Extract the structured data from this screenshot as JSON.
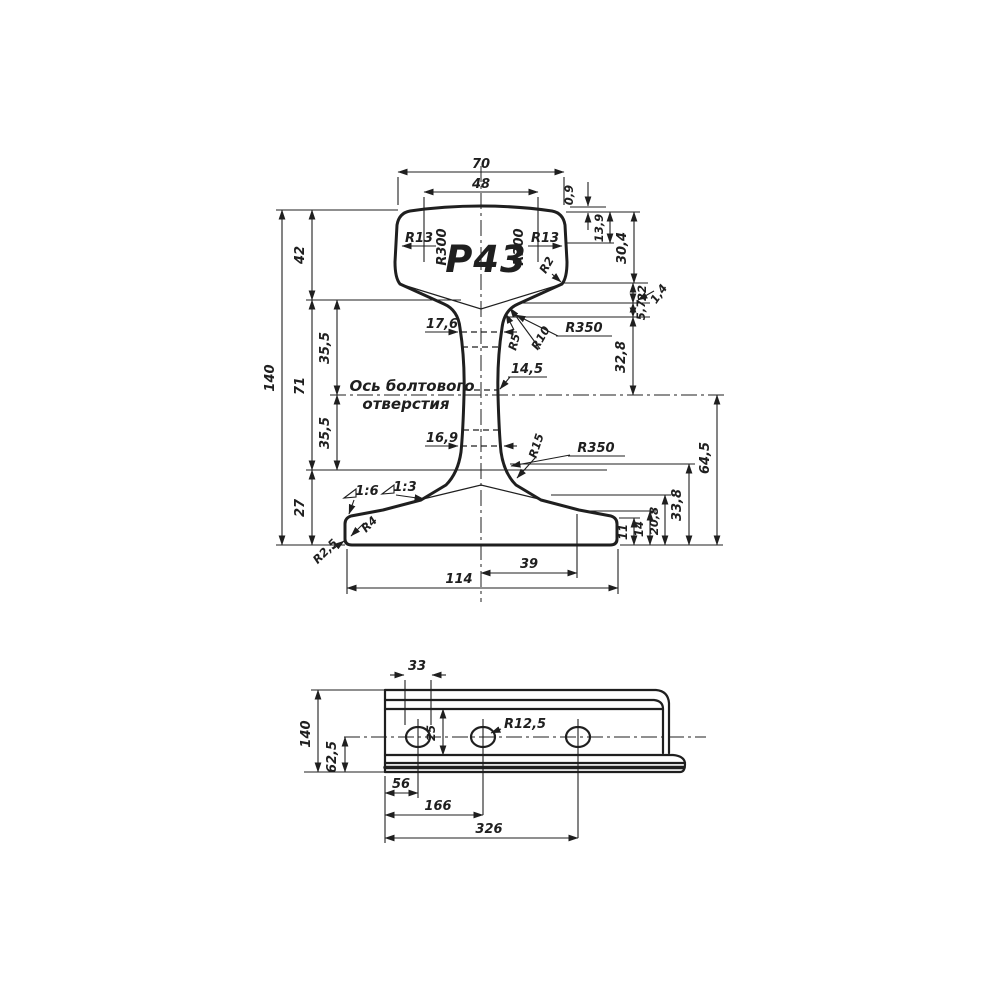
{
  "drawing": {
    "ink_color": "#1f1f1f",
    "background": "#ffffff",
    "cross_section": {
      "designation": "Р43",
      "note_line1": "Ось болтового",
      "note_line2": "отверстия",
      "dims": {
        "head_width": "70",
        "head_top_flat": "48",
        "crown_rise": "0,9",
        "corner_radius_left": "R13",
        "crown_radius_left": "R300",
        "crown_radius_right": "R300",
        "corner_radius_right": "R13",
        "head_side_radius": "R2",
        "head_depth": "13,9",
        "head_height": "30,4",
        "under_head_1": "22",
        "under_head_2": "5,7",
        "under_head_3": "1,4",
        "head_to_axis": "32,8",
        "web_top": "17,6",
        "web_mid": "14,5",
        "web_bottom": "16,9",
        "fillet_r5": "R5",
        "fillet_r10": "R10",
        "fillet_r350_upper": "R350",
        "fillet_r15": "R15",
        "fillet_r350_lower": "R350",
        "total_height": "140",
        "head_zone": "42",
        "web_zone": "71",
        "foot_zone": "27",
        "axis_above": "35,5",
        "axis_below": "35,5",
        "slope_outer": "1:6",
        "slope_inner": "1:3",
        "foot_corner_radius": "R4",
        "foot_edge_radius": "R2,5",
        "axis_to_foot": "64,5",
        "foot_rise_a": "33,8",
        "foot_rise_b": "20,8",
        "foot_edge_b": "14",
        "foot_edge_a": "11",
        "foot_half": "39",
        "foot_width": "114"
      }
    },
    "side_view": {
      "dims": {
        "rail_height": "140",
        "hole_axis_height": "62,5",
        "hole_length": "33",
        "web_band_height": "25",
        "hole_radius": "R12,5",
        "hole1_offset": "56",
        "hole2_offset": "166",
        "hole3_offset": "326"
      }
    }
  }
}
